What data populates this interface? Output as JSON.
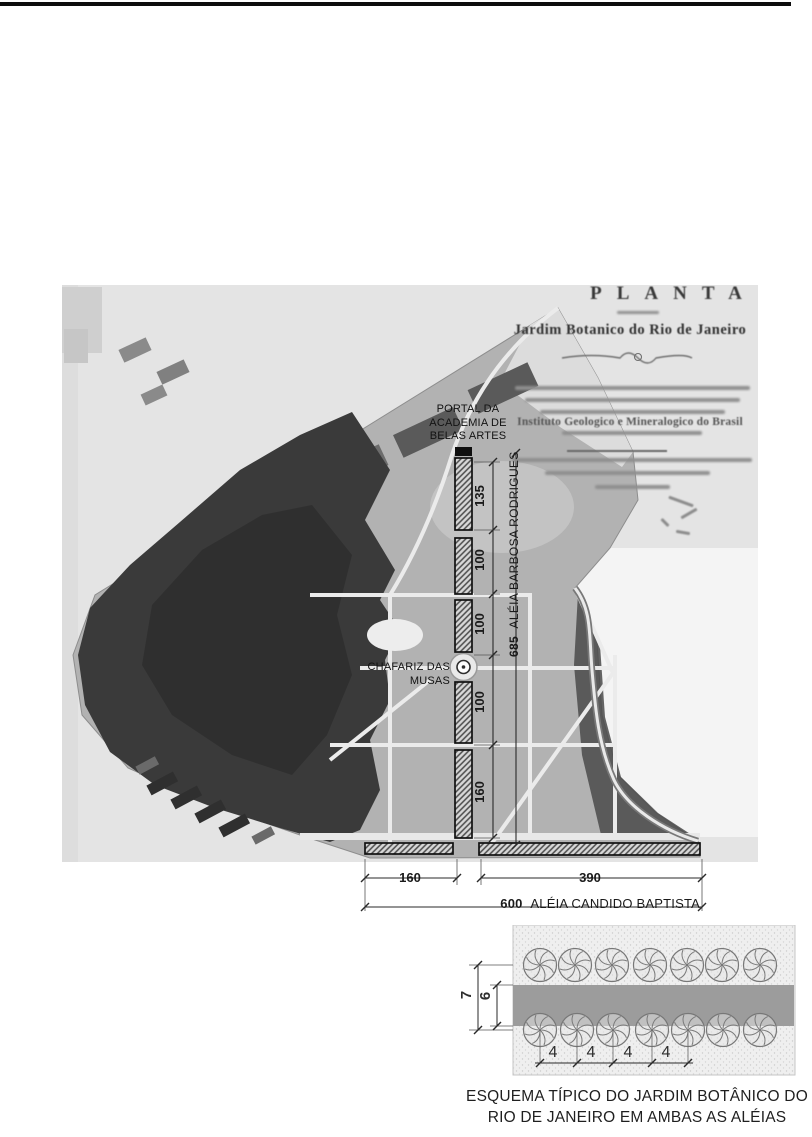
{
  "map": {
    "title_block": {
      "title": "PLANTA",
      "subtitle": "Jardim Botanico do Rio de Janeiro",
      "institute_line": "Instituto Geologico e Mineralogico do Brasil"
    },
    "annotations": {
      "portal_line1": "PORTAL DA",
      "portal_line2": "ACADEMIA DE",
      "portal_line3": "BELAS ARTES",
      "chafariz": "CHAFARIZ DAS MUSAS"
    },
    "vertical_dimension": {
      "segments": [
        "135",
        "100",
        "100",
        "100",
        "160"
      ],
      "total": "685",
      "alley_name": "ALÉIA BARBOSA RODRIGUES"
    },
    "horizontal_dimension": {
      "segments": [
        "160",
        "390"
      ],
      "total": "600",
      "alley_name": "ALÉIA CANDIDO BAPTISTA"
    }
  },
  "schematic": {
    "row_spacing_outer": "7",
    "path_width_inner": "6",
    "tree_spacings": [
      "4",
      "4",
      "4",
      "4"
    ]
  },
  "caption": {
    "line1": "ESQUEMA TÍPICO DO JARDIM BOTÂNICO DO",
    "line2": "RIO DE JANEIRO EM AMBAS AS ALÉIAS"
  }
}
